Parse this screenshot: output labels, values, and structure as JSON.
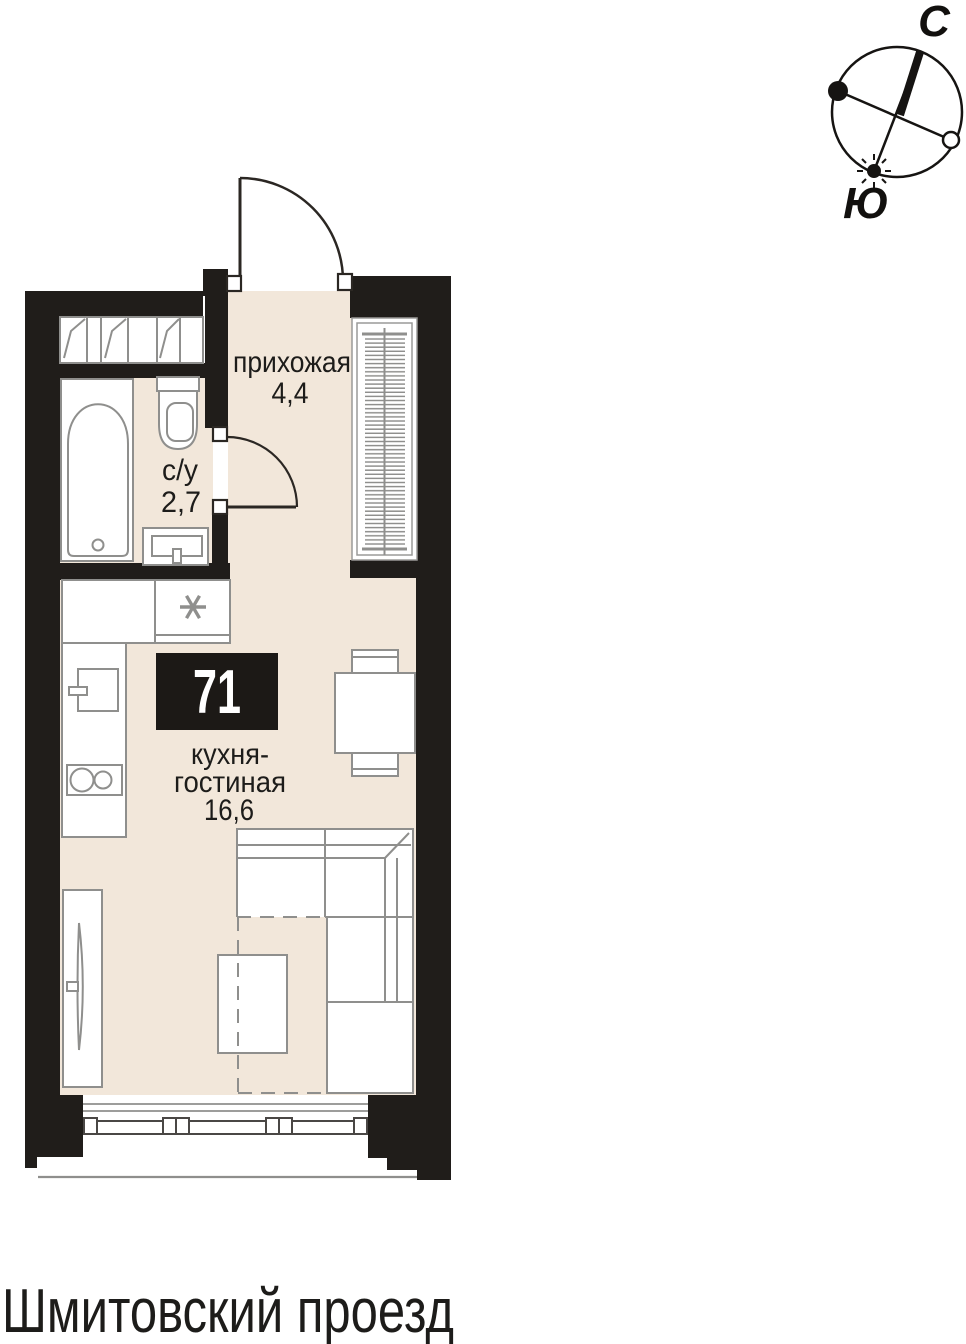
{
  "compass": {
    "north_label": "С",
    "south_label": "Ю"
  },
  "plan": {
    "apartment_number": "71",
    "rooms": {
      "hallway": {
        "label": "прихожая",
        "area": "4,4"
      },
      "bathroom": {
        "label": "с/у",
        "area": "2,7"
      },
      "kitchen_living": {
        "label_line1": "кухня-",
        "label_line2": "гостиная",
        "area": "16,6"
      }
    },
    "symbols": {
      "washer_mark": "*"
    }
  },
  "street_label": "Шмитовский проезд",
  "colors": {
    "wall": "#201d1a",
    "floor": "#f2e7da",
    "furniture_line": "#8f8f8d",
    "text": "#1d1c1a",
    "badge_bg": "#1c1916",
    "badge_text": "#ffffff"
  }
}
